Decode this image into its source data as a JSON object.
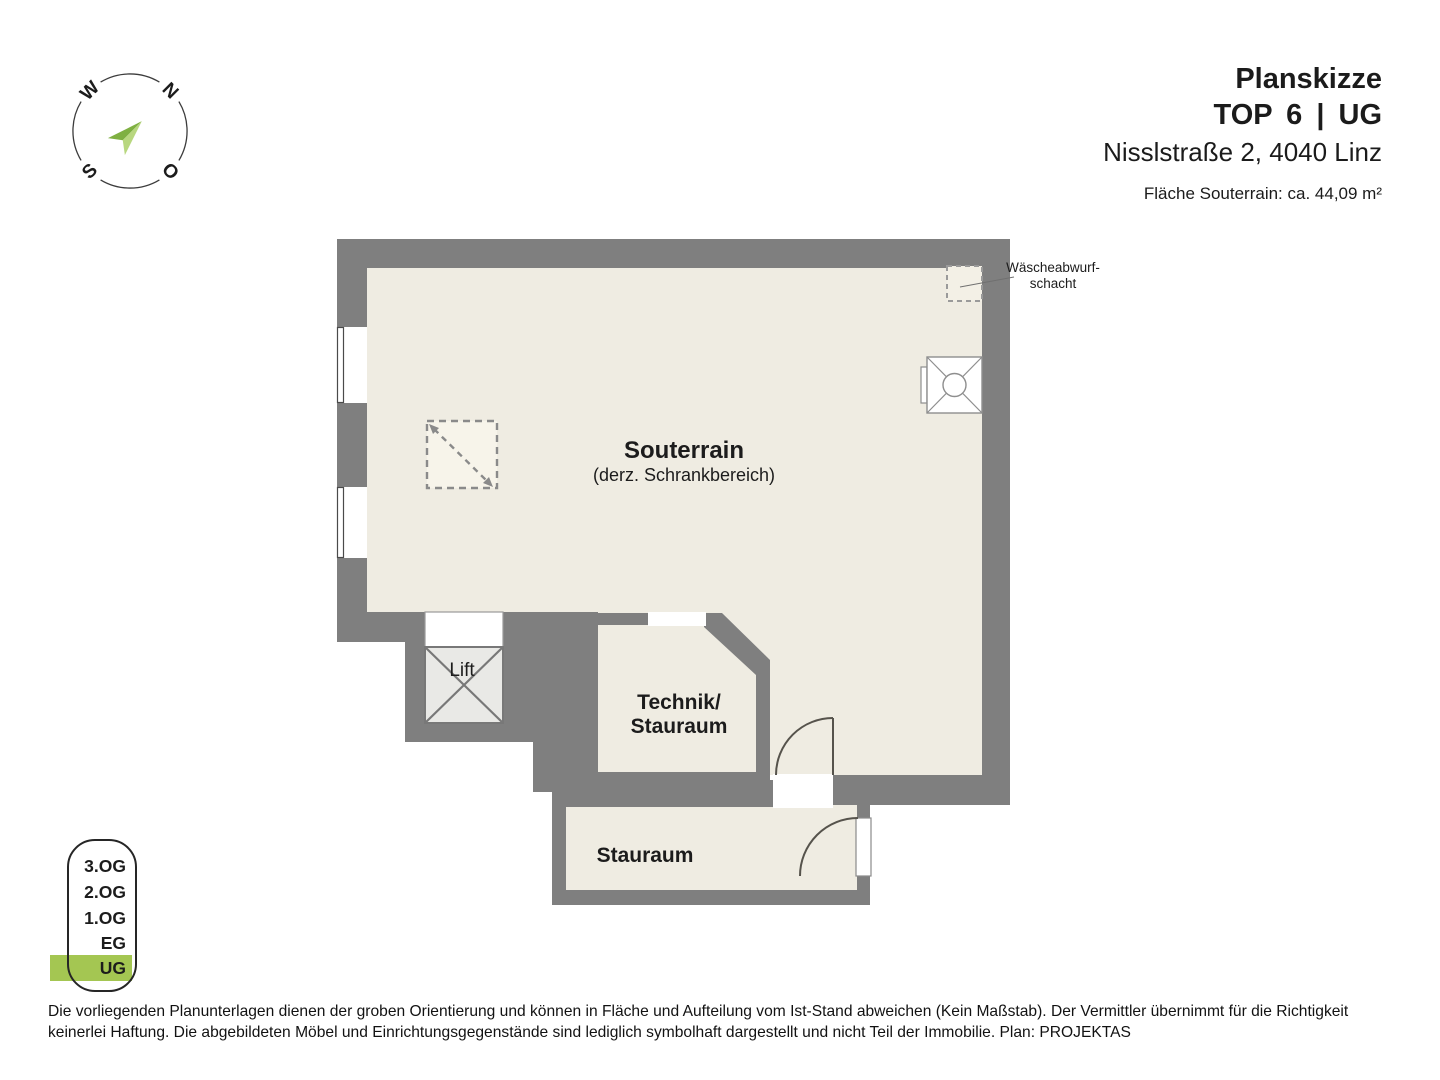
{
  "header": {
    "title": "Planskizze",
    "unit": "TOP 6  |  UG",
    "address": "Nisslstraße 2, 4040 Linz",
    "area_note": "Fläche Souterrain: ca. 44,09 m²"
  },
  "compass": {
    "n": "N",
    "o": "O",
    "s": "S",
    "w": "W"
  },
  "plan": {
    "labels": {
      "souterrain": "Souterrain",
      "souterrain_sub": "(derz. Schrankbereich)",
      "technik_line1": "Technik/",
      "technik_line2": "Stauraum",
      "stauraum": "Stauraum",
      "lift": "Lift",
      "chute_line1": "Wäscheabwurf-",
      "chute_line2": "schacht"
    }
  },
  "floor_selector": {
    "floors": [
      {
        "label": "3.OG",
        "active": false
      },
      {
        "label": "2.OG",
        "active": false
      },
      {
        "label": "1.OG",
        "active": false
      },
      {
        "label": "EG",
        "active": false
      },
      {
        "label": "UG",
        "active": true
      }
    ],
    "active_floor": "UG"
  },
  "disclaimer": {
    "line1": "Die vorliegenden Planunterlagen dienen der groben Orientierung und können in Fläche und Aufteilung vom Ist-Stand abweichen (Kein Maßstab). Der Vermittler übernimmt für die Richtigkeit",
    "line2": "keinerlei Haftung. Die abgebildeten Möbel und Einrichtungsgegenstände sind lediglich symbolhaft dargestellt und nicht Teil der Immobilie. Plan: PROJEKTAS"
  },
  "colors": {
    "wall": "#7f7f7f",
    "room_fill": "#efece2",
    "lift_fill": "#e9e9e6",
    "active_floor_green": "#a4c652",
    "compass_arrow_light": "#b8d77f",
    "compass_arrow_dark": "#7fb042"
  }
}
